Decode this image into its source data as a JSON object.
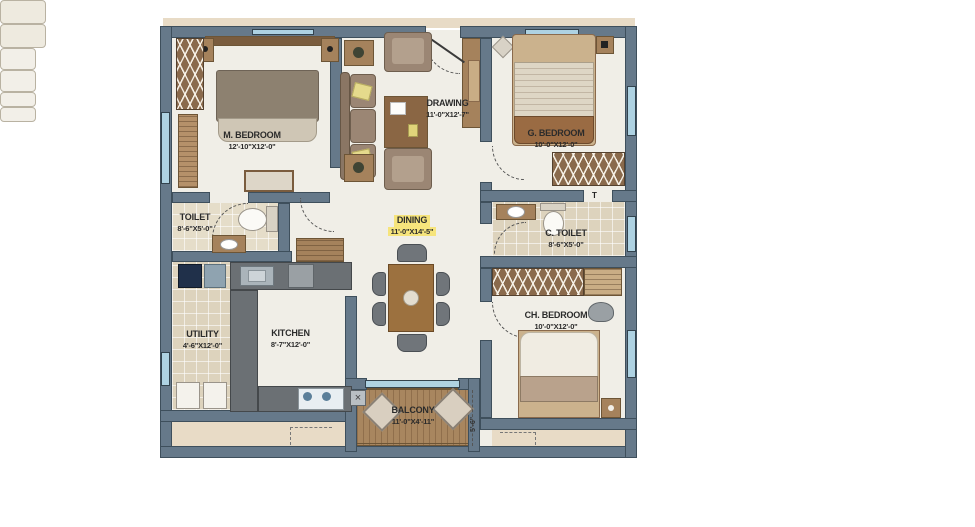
{
  "rooms": {
    "m_bedroom": {
      "name": "M. BEDROOM",
      "dims": "12'-10\"X12'-0\""
    },
    "drawing": {
      "name": "DRAWING",
      "dims": "11'-0\"X12'-7\""
    },
    "g_bedroom": {
      "name": "G. BEDROOM",
      "dims": "10'-0\"X12'-0\""
    },
    "toilet": {
      "name": "TOILET",
      "dims": "8'-6\"X5'-0\""
    },
    "dining": {
      "name": "DINING",
      "dims": "11'-0\"X14'-5\""
    },
    "c_toilet": {
      "name": "C. TOILET",
      "dims": "8'-6\"X5'-0\""
    },
    "utility": {
      "name": "UTILITY",
      "dims": "4'-6\"X12'-0\""
    },
    "kitchen": {
      "name": "KITCHEN",
      "dims": "8'-7\"X12'-0\""
    },
    "ch_bedroom": {
      "name": "CH. BEDROOM",
      "dims": "10'-0\"X12'-0\""
    },
    "balcony": {
      "name": "BALCONY",
      "dims": "11'-0\"X4'-11\""
    }
  },
  "annotations": {
    "balcony_height": "5'-6\"",
    "marker_t": "T",
    "balcony_corner_mark": "×"
  },
  "colors": {
    "wall": "#66798a",
    "floor": "#f0eee7",
    "tile": "#ddd3bd",
    "wood": "#a5825c",
    "deck": "#a8865f",
    "ledge": "#e8dbc6",
    "highlight": "#f6e47c",
    "glass": "#aed2e2"
  }
}
